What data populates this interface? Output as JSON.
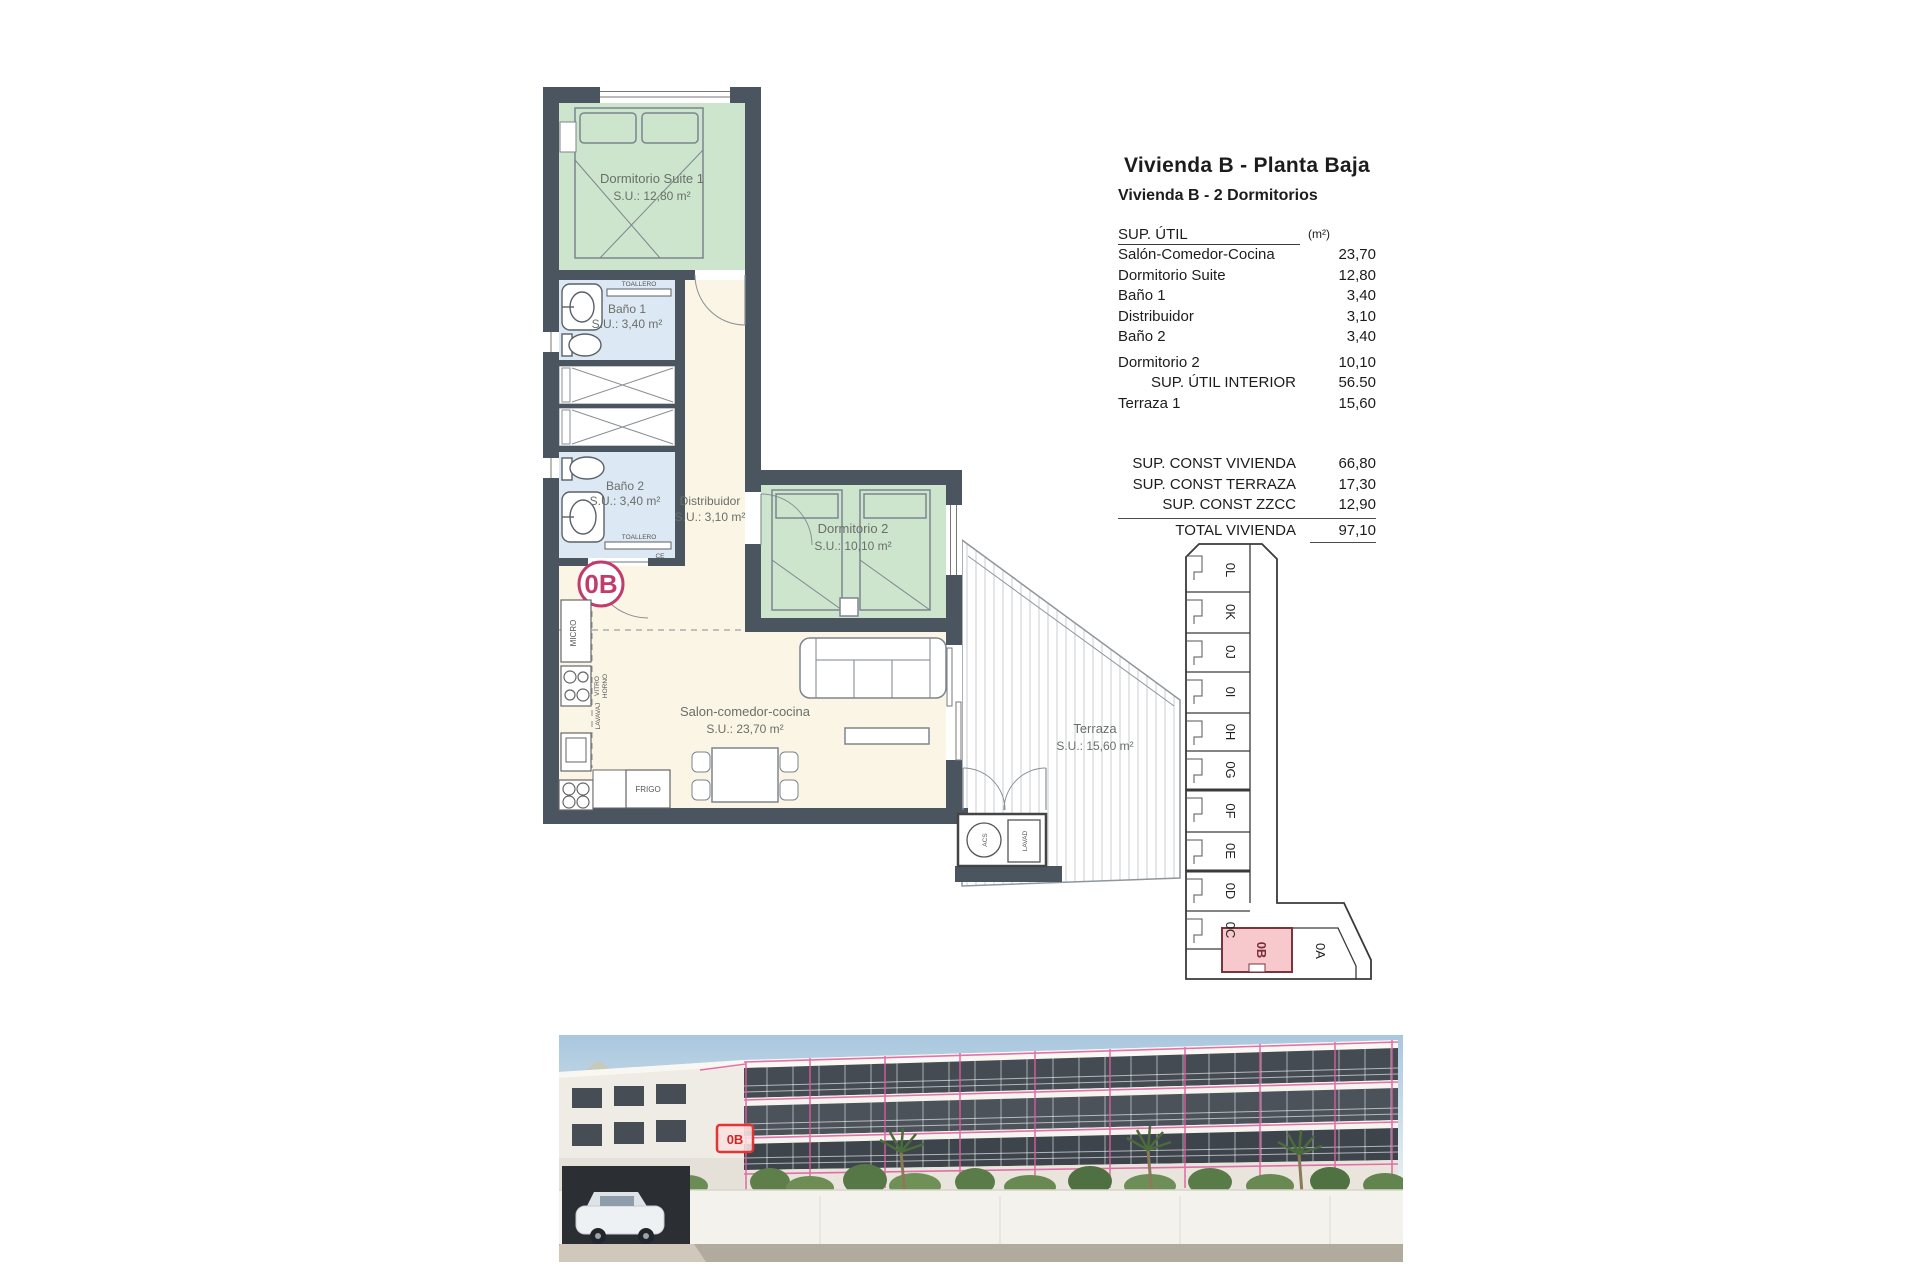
{
  "panel": {
    "title": "Vivienda B - Planta Baja",
    "subtitle": "Vivienda B - 2 Dormitorios",
    "table": {
      "header": {
        "label": "SUP. ÚTIL",
        "unit": "(m²)"
      },
      "rows": [
        {
          "label": "Salón-Comedor-Cocina",
          "value": "23,70"
        },
        {
          "label": "Dormitorio Suite",
          "value": "12,80"
        },
        {
          "label": "Baño 1",
          "value": "3,40"
        },
        {
          "label": "Distribuidor",
          "value": "3,10"
        },
        {
          "label": "Baño 2",
          "value": "3,40"
        },
        {
          "label": "Dormitorio 2",
          "value": "10,10"
        }
      ],
      "interior_row": {
        "label": "SUP. ÚTIL INTERIOR",
        "value": "56.50"
      },
      "terraza_row": {
        "label": "Terraza 1",
        "value": "15,60"
      },
      "summary_rows": [
        {
          "label": "SUP. CONST VIVIENDA",
          "value": "66,80"
        },
        {
          "label": "SUP. CONST TERRAZA",
          "value": "17,30"
        },
        {
          "label": "SUP. CONST ZZCC",
          "value": "12,90"
        }
      ],
      "total_row": {
        "label": "TOTAL VIVIENDA",
        "value": "97,10"
      }
    }
  },
  "plan": {
    "unit_badge": "0B",
    "rooms": {
      "suite": {
        "name": "Dormitorio Suite 1",
        "area": "S.U.: 12,80 m²"
      },
      "bano1": {
        "name": "Baño 1",
        "area": "S.U.: 3,40 m²"
      },
      "bano2": {
        "name": "Baño 2",
        "area": "S.U.: 3,40 m²"
      },
      "distribuidor": {
        "name": "Distribuidor",
        "area": "S.U.: 3,10 m²"
      },
      "dormitorio2": {
        "name": "Dormitorio 2",
        "area": "S.U.: 10,10 m²"
      },
      "salon": {
        "name": "Salon-comedor-cocina",
        "area": "S.U.: 23,70 m²"
      },
      "terraza": {
        "name": "Terraza",
        "area": "S.U.: 15,60 m²"
      }
    },
    "fixtures": {
      "toallero1": "TOALLERO",
      "toallero2": "TOALLERO",
      "micro": "MICRO",
      "vitro": "VITRO",
      "horno": "HORNO",
      "lavavaj": "LAVAVAJ",
      "frigo": "FRIGO",
      "acs": "ACS",
      "lavad": "LAVAD",
      "ce": "CE"
    }
  },
  "keyplan": {
    "units": [
      "0L",
      "0K",
      "0J",
      "0I",
      "0H",
      "0G",
      "0F",
      "0E",
      "0D",
      "0C"
    ],
    "unit_b": "0B",
    "unit_a": "0A"
  },
  "photo": {
    "marker": "0B"
  },
  "colors": {
    "wall": "#4a5560",
    "room_green": "#cde5cd",
    "room_blue": "#dce8f3",
    "room_cream": "#fbf5e6",
    "badge_magenta": "#c13c6d",
    "keyplan_highlight": "#f7c9cd",
    "photo_outline": "#de5c9e"
  }
}
